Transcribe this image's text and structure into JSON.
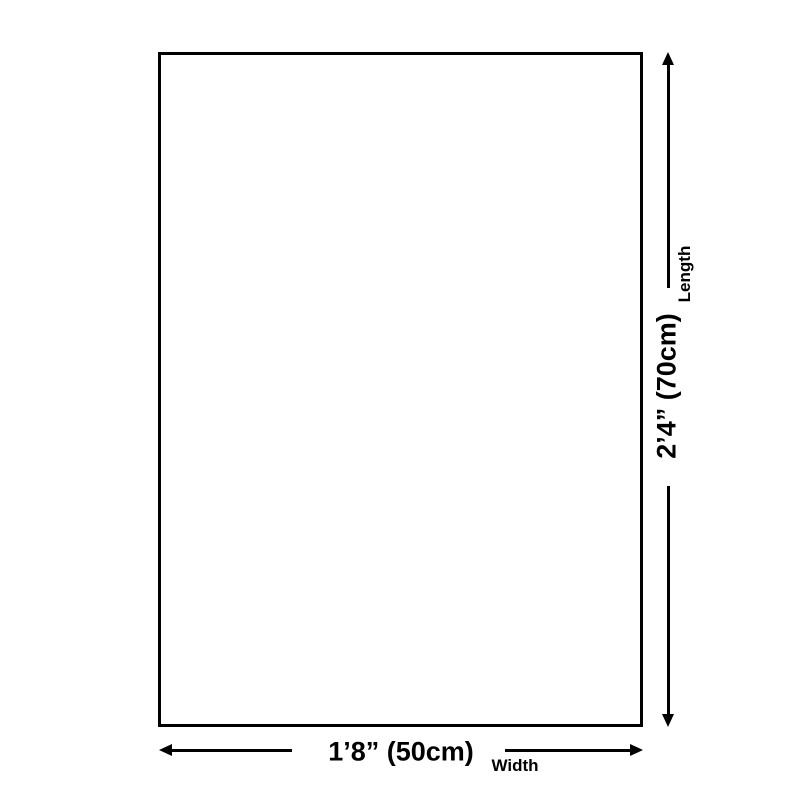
{
  "page": {
    "background_color": "#ffffff"
  },
  "diagram": {
    "type": "product-dimension-diagram",
    "colors": {
      "line": "#000000",
      "text": "#000000",
      "box_fill": "#ffffff"
    },
    "length": {
      "value": "2’4” (70cm)",
      "label": "Length"
    },
    "width": {
      "value": "1’8” (50cm)",
      "label": "Width"
    }
  }
}
